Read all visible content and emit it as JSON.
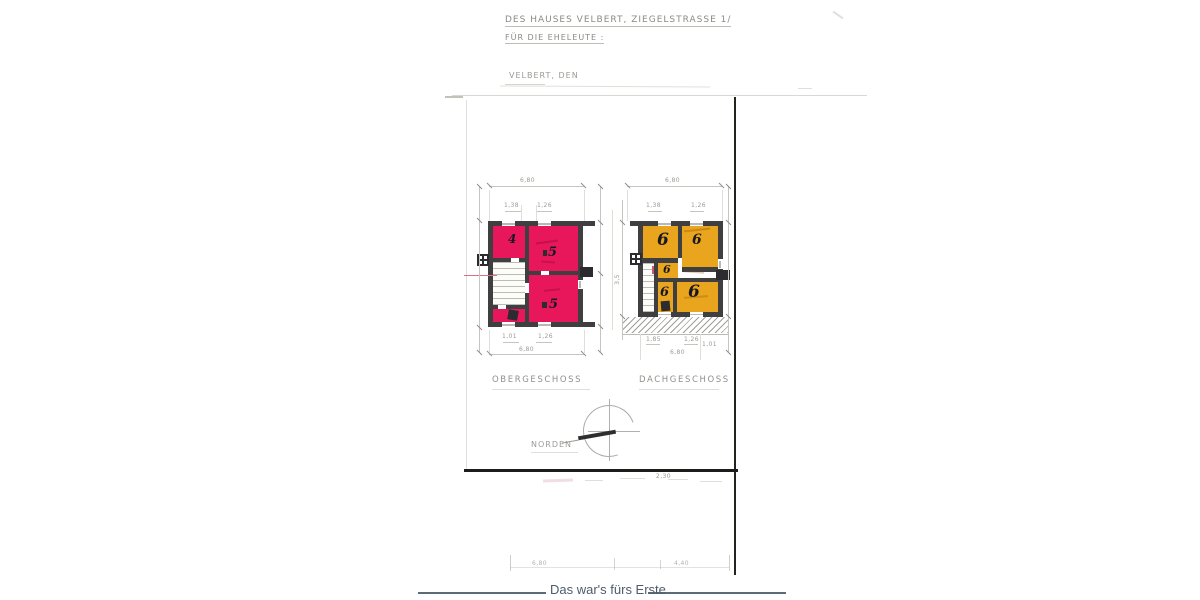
{
  "header": {
    "line1": "DES HAUSES VELBERT, ZIEGELSTRASSE 1/",
    "line2": "FÜR DIE EHELEUTE :",
    "city_date": "VELBERT, DEN"
  },
  "floor_plans": {
    "obergeschoss": {
      "label": "OBERGESCHOSS",
      "fill_color": "#e8175c",
      "rooms": [
        {
          "number": "4"
        },
        {
          "number": "5"
        },
        {
          "number": "5"
        }
      ],
      "dimensions": {
        "top_total": "6,80",
        "top_left": "1,38",
        "top_right": "1,26",
        "bottom_left": "1,01",
        "bottom_right": "1,26",
        "bottom_total": "6,80"
      }
    },
    "dachgeschoss": {
      "label": "DACHGESCHOSS",
      "fill_color": "#eaa51e",
      "rooms": [
        {
          "number": "6"
        },
        {
          "number": "6"
        },
        {
          "number": "6"
        },
        {
          "number": "6"
        },
        {
          "number": "6"
        }
      ],
      "dimensions": {
        "top_total": "6,80",
        "top_left": "1,38",
        "top_right": "1,26",
        "left_height": "3,5",
        "bottom_a": "1,85",
        "bottom_b": "1,26",
        "bottom_c": "1,01",
        "bottom_total": "6,80"
      }
    }
  },
  "compass": {
    "label": "NORDEN"
  },
  "lower_sheet": {
    "dim_small": "2,30",
    "dim_left": "6,80",
    "dim_right": "4,40"
  },
  "footer": {
    "caption": "Das war's fürs Erste"
  },
  "colors": {
    "wall": "#3f3f42",
    "pink_room": "#e8175c",
    "orange_room": "#eaa51e",
    "footer_text": "#4d5c6b"
  }
}
